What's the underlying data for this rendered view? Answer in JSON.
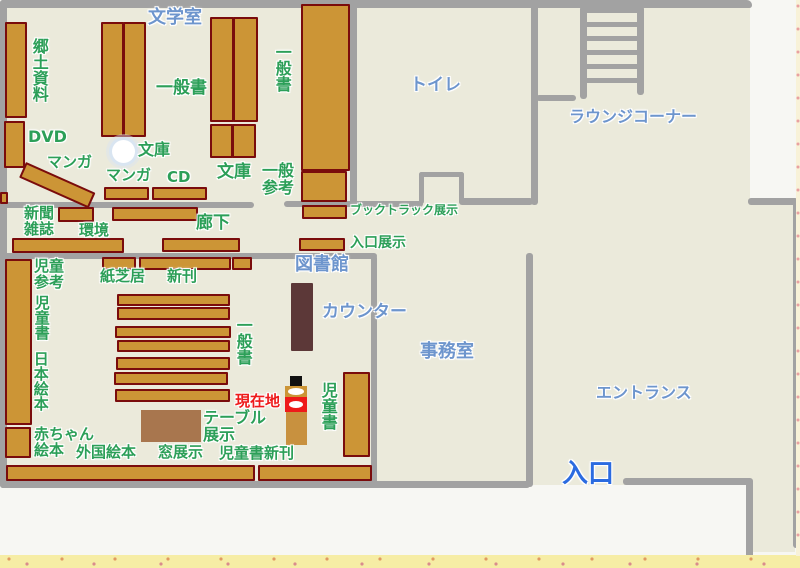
{
  "map_title": "library floor map",
  "colors": {
    "floor": "#ebeadb",
    "wall": "#a2a2a2",
    "shelf_fill": "#cc9536",
    "shelf_border": "#7a0c0c",
    "counter_fill": "#5c3838",
    "table_fill": "#a8764e",
    "label_green": "#2c9f58",
    "label_blue": "#6d95cd",
    "label_blue_bright": "#2b6be0",
    "label_red": "#ee1a1a"
  },
  "rooms": {
    "bungakushitsu": "文学室",
    "toilet": "トイレ",
    "lounge": "ラウンジコーナー",
    "toshokan": "図書館",
    "counter": "カウンター",
    "jimushitsu": "事務室",
    "entrance_hall": "エントランス",
    "entrance_door": "入口"
  },
  "areas": {
    "kyodo_shiryo": "郷土資料",
    "dvd": "DVD",
    "manga_a": "マンガ",
    "manga_b": "マンガ",
    "cd": "CD",
    "bunko_a": "文庫",
    "bunko_b": "文庫",
    "ippansho_a": "一般書",
    "ippansho_b": "一般書",
    "ippansho_c": "一般書",
    "ippan_sanko": "一般参考",
    "booktruck_tenji": "ブックトラック展示",
    "iriguchi_tenji": "入口展示",
    "shinbun_zasshi": "新聞雑誌",
    "kankyo": "環境",
    "rouka": "廊下",
    "jido_sanko": "児童参考",
    "jidosho_a": "児童書",
    "jidosho_b": "児童書",
    "nihon_ehon": "日本絵本",
    "akachan_ehon": "赤ちゃん絵本",
    "gaikoku_ehon": "外国絵本",
    "kamishibai": "紙芝居",
    "shinkan": "新刊",
    "table_tenji": "テーブル展示",
    "mado_tenji": "窓展示",
    "jidosho_shinkan": "児童書新刊"
  },
  "marker": {
    "genzaichi": "現在地"
  }
}
